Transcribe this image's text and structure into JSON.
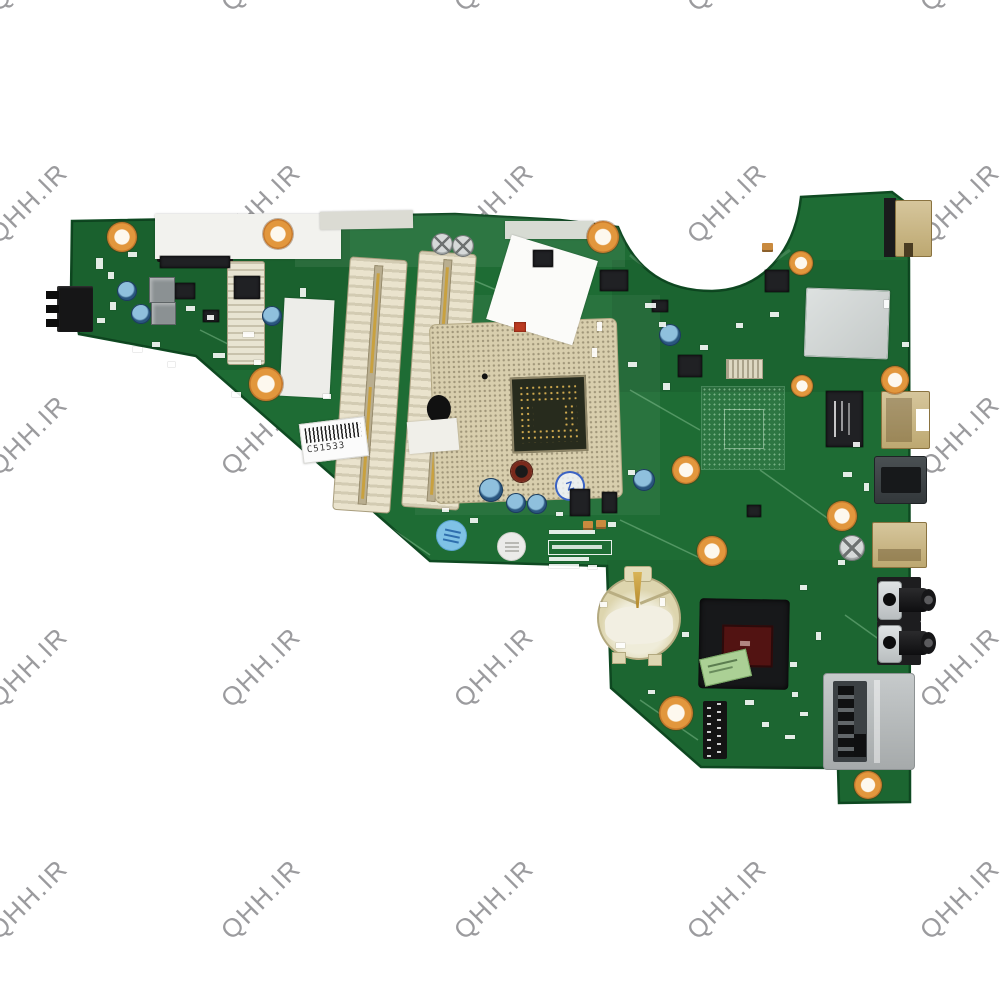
{
  "watermark": {
    "text": "QHH.IR",
    "color": "#9b9b9e",
    "rotation_deg": -45,
    "grid": {
      "x_start": 33,
      "x_step": 233,
      "cols": 5,
      "y_start": -28,
      "y_step": 232,
      "rows": 5
    }
  },
  "labels": {
    "barcode": "C51533",
    "stamp_b4": "B4",
    "stamp_z": "Z"
  },
  "palette": {
    "pcb_green": "#1e6c34",
    "pcb_edge": "#0f4a22",
    "copper": "#d28a35",
    "socket_beige": "#d8cead",
    "slot_cream": "#eae3cd",
    "battery_beige": "#e3dcba",
    "chip_black": "#202124",
    "die_red": "#5a1412",
    "label_green": "#abd095",
    "port_tan": "#c8b488",
    "metal_silver": "#b9bdbe",
    "stamp_blue": "#3b63c4",
    "ink_blue": "#7fc2e6"
  },
  "components": {
    "holes": [
      [
        122,
        237,
        15
      ],
      [
        278,
        234,
        15
      ],
      [
        603,
        237,
        16
      ],
      [
        266,
        384,
        17
      ],
      [
        801,
        263,
        12
      ],
      [
        802,
        386,
        11
      ],
      [
        895,
        380,
        14
      ],
      [
        842,
        516,
        15
      ],
      [
        712,
        551,
        15
      ],
      [
        686,
        470,
        14
      ],
      [
        676,
        713,
        17
      ],
      [
        868,
        785,
        14
      ]
    ],
    "blue_caps": [
      [
        127,
        291,
        10
      ],
      [
        141,
        314,
        10
      ],
      [
        272,
        316,
        10
      ],
      [
        670,
        335,
        11
      ],
      [
        491,
        490,
        12
      ],
      [
        516,
        503,
        10
      ],
      [
        537,
        504,
        10
      ],
      [
        644,
        480,
        11
      ]
    ],
    "silver_caps": [
      [
        442,
        244,
        11
      ],
      [
        463,
        246,
        11
      ],
      [
        852,
        548,
        13
      ]
    ],
    "chips": [
      [
        533,
        250,
        20,
        17
      ],
      [
        600,
        270,
        28,
        21
      ],
      [
        765,
        270,
        24,
        22
      ],
      [
        678,
        355,
        24,
        22
      ],
      [
        570,
        489,
        20,
        27
      ],
      [
        602,
        492,
        15,
        21
      ],
      [
        234,
        276,
        26,
        23
      ],
      [
        175,
        283,
        20,
        16
      ],
      [
        203,
        310,
        16,
        12
      ],
      [
        747,
        505,
        14,
        12
      ],
      [
        652,
        300,
        16,
        12
      ],
      [
        160,
        256,
        70,
        12
      ]
    ],
    "gray_blocks": [
      [
        149,
        277,
        24,
        24
      ],
      [
        151,
        302,
        23,
        21
      ]
    ],
    "tan_caps": [
      [
        583,
        521,
        10,
        9
      ],
      [
        596,
        520,
        10,
        9
      ],
      [
        762,
        243,
        11,
        9
      ]
    ],
    "red_parts": [
      [
        514,
        322,
        12,
        10
      ]
    ],
    "smds": [
      [
        96,
        258,
        7,
        11
      ],
      [
        108,
        272,
        6,
        7
      ],
      [
        128,
        252,
        9,
        5
      ],
      [
        186,
        306,
        9,
        5
      ],
      [
        207,
        315,
        7,
        5
      ],
      [
        243,
        332,
        11,
        5
      ],
      [
        152,
        342,
        8,
        5
      ],
      [
        213,
        353,
        12,
        5
      ],
      [
        254,
        360,
        7,
        5
      ],
      [
        110,
        302,
        6,
        8
      ],
      [
        97,
        318,
        8,
        5
      ],
      [
        133,
        347,
        9,
        5
      ],
      [
        168,
        362,
        7,
        5
      ],
      [
        232,
        392,
        9,
        5
      ],
      [
        323,
        394,
        8,
        5
      ],
      [
        597,
        322,
        5,
        9
      ],
      [
        592,
        348,
        5,
        9
      ],
      [
        645,
        303,
        11,
        5
      ],
      [
        659,
        322,
        7,
        5
      ],
      [
        628,
        362,
        9,
        5
      ],
      [
        663,
        383,
        7,
        7
      ],
      [
        700,
        345,
        8,
        5
      ],
      [
        770,
        312,
        9,
        5
      ],
      [
        736,
        323,
        7,
        5
      ],
      [
        884,
        300,
        5,
        8
      ],
      [
        902,
        342,
        7,
        5
      ],
      [
        853,
        442,
        7,
        5
      ],
      [
        843,
        472,
        9,
        5
      ],
      [
        864,
        483,
        5,
        8
      ],
      [
        838,
        560,
        7,
        5
      ],
      [
        800,
        585,
        7,
        5
      ],
      [
        816,
        632,
        5,
        8
      ],
      [
        790,
        662,
        7,
        5
      ],
      [
        745,
        700,
        9,
        5
      ],
      [
        762,
        722,
        7,
        5
      ],
      [
        792,
        692,
        6,
        5
      ],
      [
        800,
        712,
        8,
        4
      ],
      [
        785,
        735,
        10,
        4
      ],
      [
        660,
        598,
        5,
        8
      ],
      [
        682,
        632,
        7,
        5
      ],
      [
        616,
        643,
        9,
        5
      ],
      [
        600,
        602,
        7,
        5
      ],
      [
        648,
        690,
        7,
        4
      ],
      [
        628,
        470,
        7,
        5
      ],
      [
        608,
        522,
        8,
        5
      ],
      [
        588,
        565,
        9,
        4
      ],
      [
        470,
        518,
        8,
        5
      ],
      [
        442,
        508,
        7,
        4
      ],
      [
        556,
        512,
        7,
        4
      ],
      [
        300,
        288,
        6,
        9
      ]
    ],
    "stickers": [
      [
        155,
        214,
        186,
        45,
        0,
        "#f2f2ee"
      ],
      [
        320,
        211,
        93,
        18,
        -1,
        "#dbdbd3"
      ],
      [
        505,
        221,
        89,
        18,
        0,
        "#d7dbd3"
      ],
      [
        497,
        246,
        90,
        88,
        17,
        "#fbfbf9"
      ],
      [
        282,
        299,
        50,
        98,
        3,
        "#edede9"
      ],
      [
        408,
        420,
        50,
        32,
        -5,
        "#f0efe9"
      ]
    ]
  }
}
